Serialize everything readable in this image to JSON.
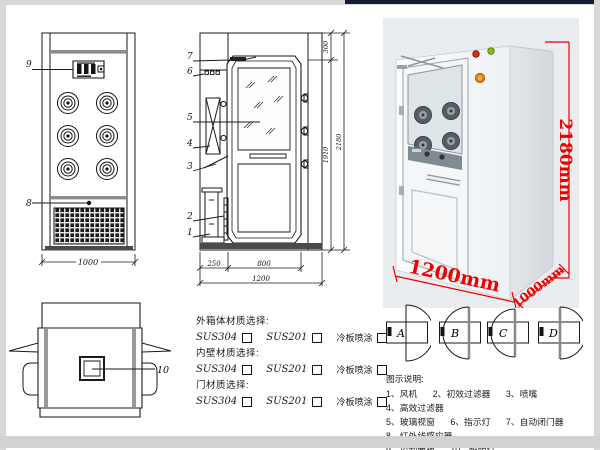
{
  "front_view": {
    "callout_control_panel": "9",
    "callout_ir_sensor": "8",
    "dim_width": "1000"
  },
  "section_view": {
    "callouts": [
      "1",
      "2",
      "3",
      "4",
      "5",
      "6",
      "7"
    ],
    "dims": {
      "top": "300",
      "inner_height": "1910",
      "total_height": "2180",
      "left": "250",
      "door": "800",
      "total_width": "1200"
    }
  },
  "plan_view": {
    "callout_lamp": "10"
  },
  "photo": {
    "dims": {
      "height": "2180mm",
      "width": "1200mm",
      "depth": "1000mm"
    }
  },
  "materials": {
    "groups": [
      {
        "title": "外箱体材质选择:",
        "options": [
          "SUS304",
          "SUS201",
          "冷板喷涂"
        ]
      },
      {
        "title": "内壁材质选择:",
        "options": [
          "SUS304",
          "SUS201",
          "冷板喷涂"
        ]
      },
      {
        "title": "门材质选择:",
        "options": [
          "SUS304",
          "SUS201",
          "冷板喷涂"
        ]
      }
    ]
  },
  "door_options": {
    "labels": [
      "A",
      "B",
      "C",
      "D"
    ]
  },
  "legend": {
    "title": "图示说明:",
    "rows": [
      [
        "1、风机",
        "2、初效过滤器",
        "3、喷嘴",
        "4、高效过滤器"
      ],
      [
        "5、玻璃视窗",
        "6、指示灯",
        "7、自动闭门器",
        "8、红外线感应器"
      ],
      [
        "9、控制面板",
        "10、照明灯"
      ]
    ]
  },
  "colors": {
    "dimension_red": "#ee0000",
    "drawing_line": "#1a1a1a",
    "frame_gray": "#d8d8d8"
  }
}
